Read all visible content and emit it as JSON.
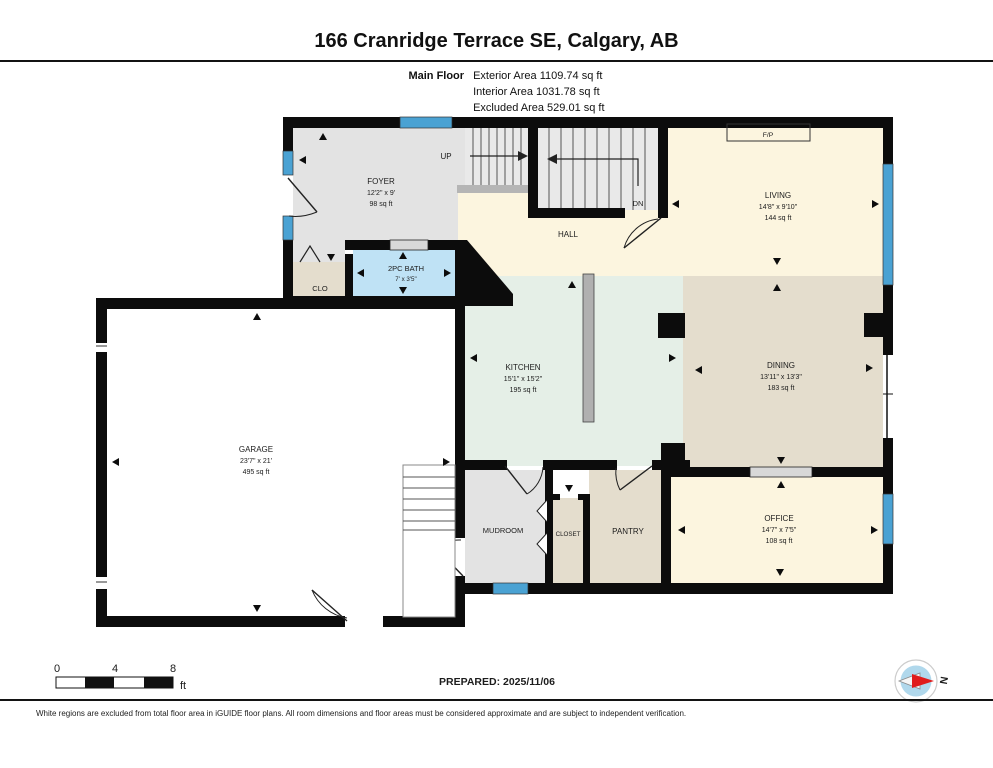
{
  "header": {
    "title": "166 Cranridge Terrace SE, Calgary, AB",
    "floor_label": "Main Floor",
    "areas": [
      "Exterior Area 1109.74 sq ft",
      "Interior Area 1031.78 sq ft",
      "Excluded Area 529.01 sq ft"
    ]
  },
  "rooms": {
    "foyer": {
      "name": "FOYER",
      "dims": "12'2\" x 9'",
      "area": "98 sq ft"
    },
    "living": {
      "name": "LIVING",
      "dims": "14'8\" x 9'10\"",
      "area": "144 sq ft"
    },
    "hall": {
      "name": "HALL"
    },
    "bath": {
      "name": "2PC BATH",
      "dims": "7' x 3'5\""
    },
    "clo": {
      "name": "CLO"
    },
    "kitchen": {
      "name": "KITCHEN",
      "dims": "15'1\" x 15'2\"",
      "area": "195 sq ft"
    },
    "dining": {
      "name": "DINING",
      "dims": "13'11\" x 13'3\"",
      "area": "183 sq ft"
    },
    "garage": {
      "name": "GARAGE",
      "dims": "23'7\" x 21'",
      "area": "495 sq ft"
    },
    "mudroom": {
      "name": "MUDROOM"
    },
    "closet": {
      "name": "CLOSET"
    },
    "pantry": {
      "name": "PANTRY"
    },
    "office": {
      "name": "OFFICE",
      "dims": "14'7\" x 7'5\"",
      "area": "108 sq ft"
    },
    "fireplace": {
      "name": "F/P"
    }
  },
  "stairs": {
    "up_label": "UP",
    "down_label": "DN"
  },
  "scale_bar": {
    "tick0": "0",
    "tick1": "4",
    "tick2": "8",
    "unit": "ft"
  },
  "footer": {
    "prepared": "PREPARED: 2025/11/06",
    "compass_label": "N",
    "disclaimer": "White regions are excluded from total floor area in iGUIDE floor plans. All room dimensions and floor areas must be considered approximate and are subject to independent verification."
  },
  "colors": {
    "wall": "#0c0c0c",
    "window": "#4aa2d3",
    "floor_cream": "#fcf5df",
    "floor_mint": "#e5efe7",
    "floor_tan": "#e4ddcd",
    "floor_gray": "#e3e3e3",
    "floor_bath": "#bfe2f5",
    "compass_red": "#e01b1b"
  }
}
